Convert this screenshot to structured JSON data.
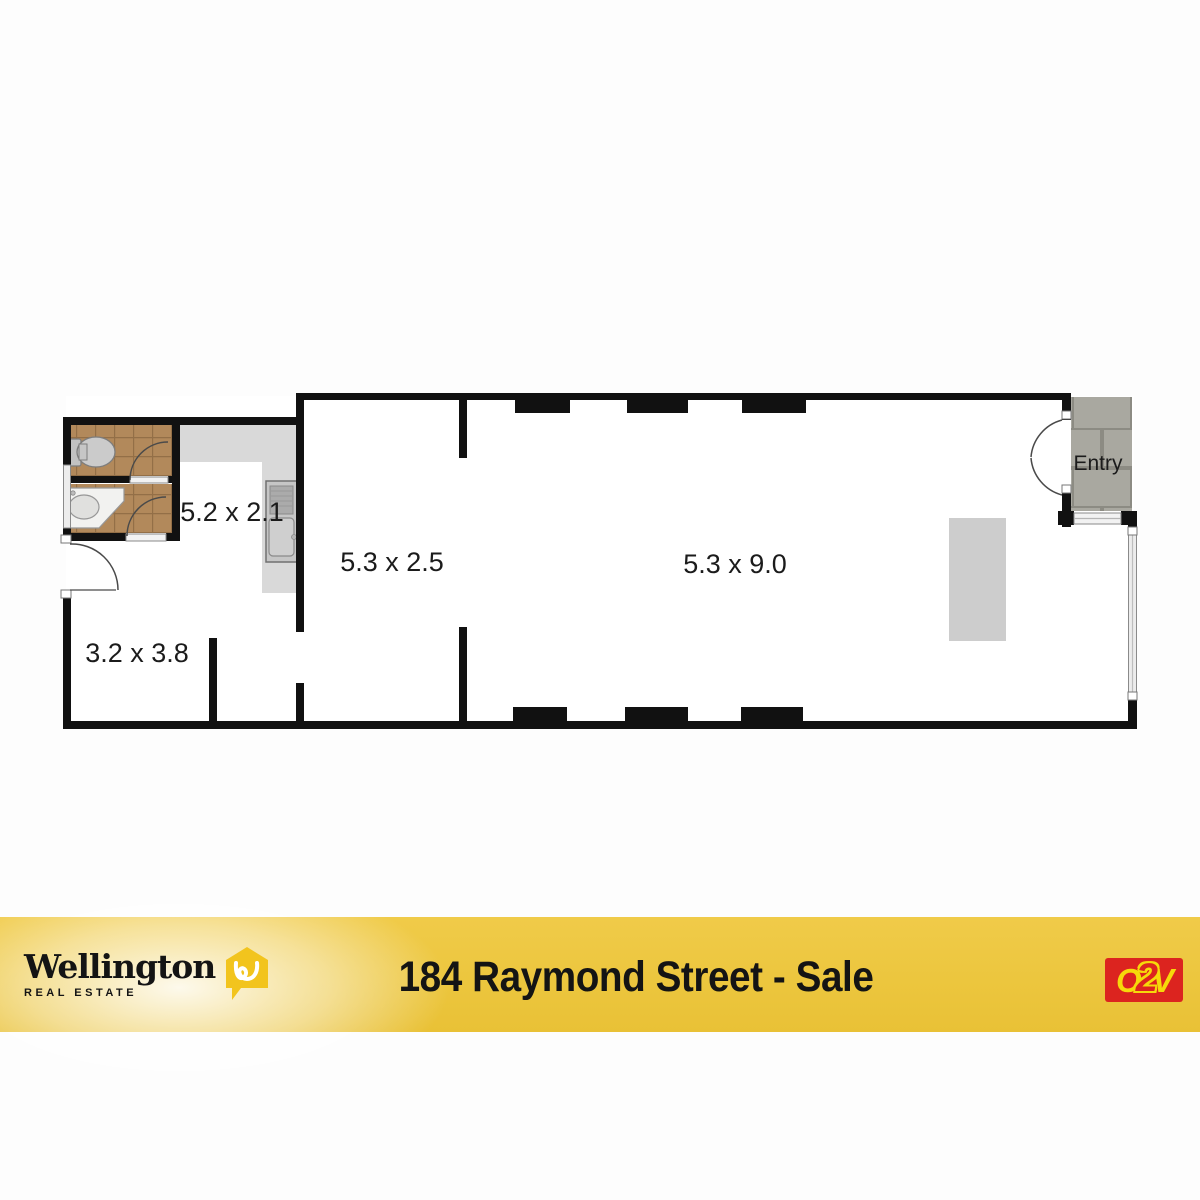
{
  "page": {
    "background": "#fdfdfd"
  },
  "floorplan": {
    "rooms": [
      {
        "id": "kitchen-room",
        "label": "5.2 x 2.1"
      },
      {
        "id": "middle-room",
        "label": "5.3 x 2.5"
      },
      {
        "id": "main-room",
        "label": "5.3 x 9.0"
      },
      {
        "id": "front-room",
        "label": "3.2 x 3.8"
      }
    ],
    "entry_label": "Entry",
    "colors": {
      "wall": "#111111",
      "bathroom_tile": "#b2895b",
      "tile_grout": "#936f47",
      "paving": "#a9a8a0",
      "paving_grout": "#8c8b83",
      "counter": "#d9d9d9",
      "island": "#cdcdcd",
      "window": "#ececec"
    }
  },
  "banner": {
    "background": "#ecc63e",
    "title": "184 Raymond Street - Sale",
    "agency": {
      "name": "Wellington",
      "tagline": "REAL ESTATE",
      "icon_color": "#f2c41d"
    },
    "partner": {
      "letters": [
        "O",
        "2",
        "V"
      ],
      "background": "#dc241f",
      "color": "#f6d90a"
    }
  }
}
